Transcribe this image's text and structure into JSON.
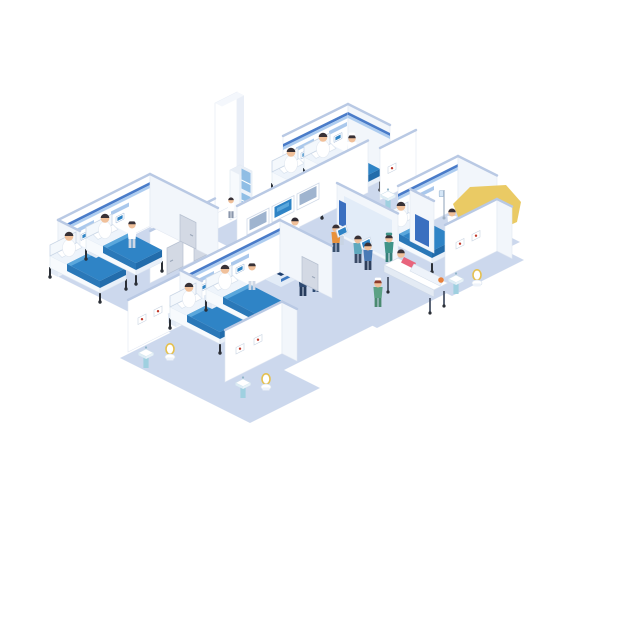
{
  "meta": {
    "title": "Isometric hospital ward floor illustration",
    "background": "#ffffff",
    "canvas_width": 640,
    "canvas_height": 640
  },
  "colors": {
    "floor": "#ccd8ed",
    "wall": "#ffffff",
    "wall_side": "#f2f6fb",
    "wall_top_edge": "#b9c9e4",
    "stripe_blue": "#4a7cc9",
    "stripe_light": "#aecdf0",
    "bed_blanket": "#2f84c6",
    "bed_blanket_light": "#5aa7dc",
    "screen_blue": "#2f84c6",
    "desk_navy": "#1d3e6e",
    "desk_blue": "#3c78c0",
    "highlight_yellow": "#e9c85f",
    "plant_green": "#4e8c46",
    "door_gray": "#d3d9e4",
    "door_blue": "#3a6fc0",
    "sink_teal": "#9fd0e0",
    "toilet_seat_yellow": "#e5c04e",
    "poster_red": "#c0392b",
    "scrubs_teal": "#3f9488",
    "nurse_dress_green": "#5ba184",
    "staff_navy": "#2e4a72",
    "staff_blue": "#4a7ab5",
    "shirt_orange": "#e8923c",
    "patient_pink": "#e8647c",
    "gurney_orange": "#e8813c",
    "skin": "#f0c09a",
    "hair": "#383136"
  },
  "reception": {
    "desk_label": "护士站",
    "wall_displays": 3
  },
  "scene": {
    "rooms": [
      {
        "id": "ward-top",
        "label": "patient ward",
        "beds": 2,
        "patients": 2,
        "staff": [
          "nurse"
        ],
        "furnishings": [
          "plant-table"
        ]
      },
      {
        "id": "ward-left",
        "label": "patient ward",
        "beds": 2,
        "patients": 2,
        "staff": [
          "nurse"
        ],
        "furnishings": [
          "plant-table",
          "plant-table"
        ],
        "bathroom": [
          "sink",
          "toilet",
          "posters"
        ]
      },
      {
        "id": "ward-bottom",
        "label": "patient ward",
        "beds": 2,
        "patients": 2,
        "staff": [
          "nurse"
        ],
        "furnishings": [
          "plant-table",
          "plant-table"
        ],
        "bathroom": [
          "sink",
          "toilet",
          "posters"
        ]
      },
      {
        "id": "ward-right",
        "label": "patient ward",
        "beds": 1,
        "patients": 1,
        "staff": [
          "doctor"
        ],
        "furnishings": [
          "plant-table",
          "iv-stand"
        ],
        "bathroom": [
          "sink",
          "toilet",
          "posters"
        ]
      }
    ],
    "reception_area": {
      "desk": "nurse-station-desk",
      "staff": [
        "receptionist"
      ],
      "wall_displays": [
        "panel",
        "screen",
        "panel"
      ]
    },
    "corridor": {
      "kiosks": 2,
      "kiosk_users": 3,
      "stretcher": {
        "patients": 1,
        "staff": [
          "surgeon"
        ]
      },
      "walking_people": [
        "nurse",
        "staff-navy",
        "staff-blue-with-bag"
      ]
    },
    "utilities": [
      "medicine-cabinet",
      "tall-white-column",
      "small-bathroom"
    ],
    "highlight": {
      "shape": "polygon",
      "position": "upper-right",
      "color_ref": "highlight_yellow"
    }
  }
}
